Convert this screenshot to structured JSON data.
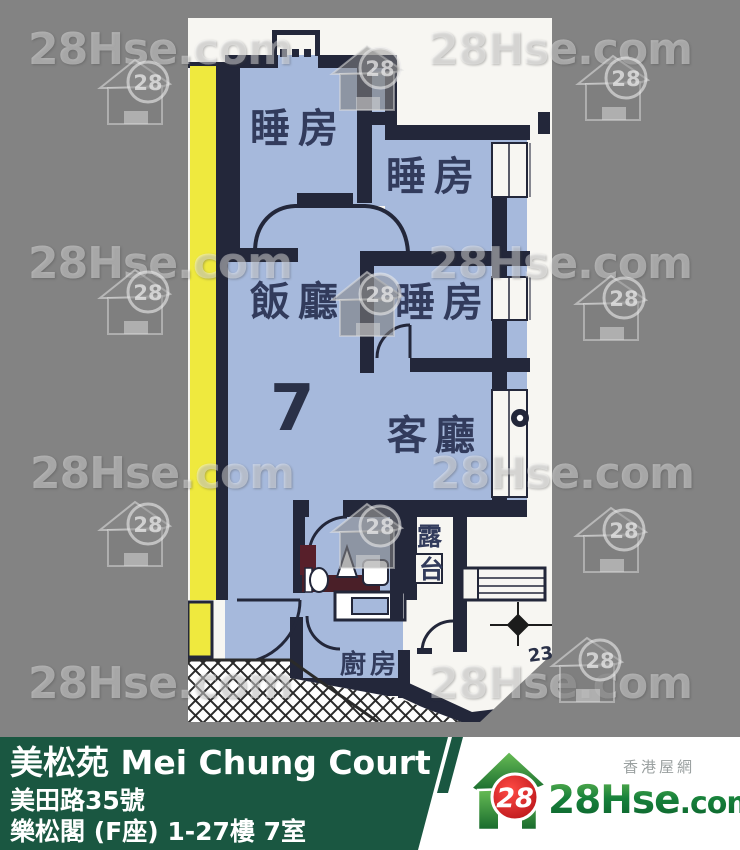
{
  "colors": {
    "background_gray": "#838383",
    "plan_white": "#f7f6f2",
    "room_blue": "#a6b9dc",
    "wall_dark": "#23273a",
    "strip_yellow": "#efe93e",
    "banner_green": "#1a5741",
    "label_navy": "#323b5c",
    "logo_red": "#d9161f",
    "logo_green": "#1f7a33"
  },
  "watermark": {
    "text": "28Hse.com",
    "badge": "28",
    "texts": [
      {
        "x": 28,
        "y": 24
      },
      {
        "x": 428,
        "y": 24
      },
      {
        "x": 28,
        "y": 238
      },
      {
        "x": 428,
        "y": 238
      },
      {
        "x": 30,
        "y": 448
      },
      {
        "x": 430,
        "y": 448
      },
      {
        "x": 28,
        "y": 658
      },
      {
        "x": 428,
        "y": 658
      }
    ],
    "icons": [
      {
        "x": 96,
        "y": 56
      },
      {
        "x": 328,
        "y": 42
      },
      {
        "x": 574,
        "y": 52
      },
      {
        "x": 96,
        "y": 266
      },
      {
        "x": 328,
        "y": 268
      },
      {
        "x": 572,
        "y": 272
      },
      {
        "x": 96,
        "y": 498
      },
      {
        "x": 328,
        "y": 500
      },
      {
        "x": 572,
        "y": 504
      },
      {
        "x": 548,
        "y": 634
      }
    ]
  },
  "floor_plan": {
    "unit_number": "7",
    "dimension_label": "23",
    "rooms": {
      "bedroom_top_left": "睡房",
      "bedroom_top_right": "睡房",
      "bedroom_middle": "睡房",
      "dining_room": "飯廳",
      "living_room": "客廳",
      "kitchen": "廚房",
      "balcony_char_1": "露",
      "balcony_char_2": "台"
    }
  },
  "banner": {
    "estate_title": "美松苑 Mei Chung Court",
    "address": "美田路35號",
    "block_floor_flat": "樂松閣 (F座) 1-27樓 7室"
  },
  "logo": {
    "badge": "28",
    "brand_main": "28Hse",
    "brand_suffix": ".com",
    "site_chinese_name": "香港屋網"
  }
}
